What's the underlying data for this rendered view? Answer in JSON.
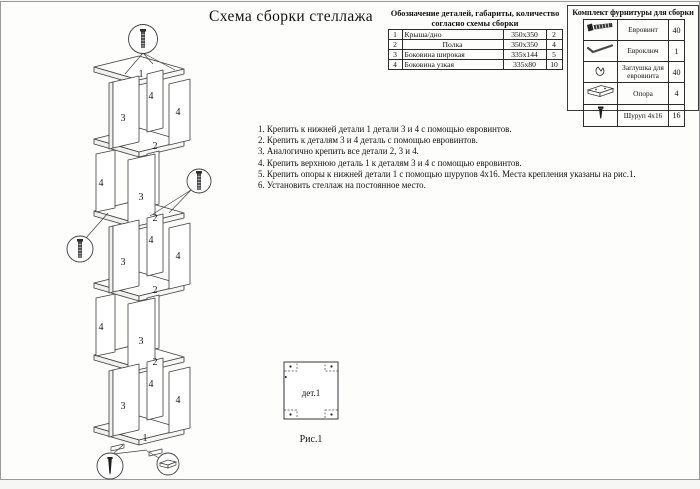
{
  "page": {
    "title": "Схема сборки стеллажа",
    "ink_color": "#2e2e2e",
    "paper_color": "#fdfdfc"
  },
  "parts_table": {
    "header_line1": "Обозначение деталей, габариты, количество",
    "header_line2": "согласно схемы сборки",
    "rows": [
      {
        "num": "1",
        "name": "Крыша/дно",
        "size": "350х350",
        "qty": "2"
      },
      {
        "num": "2",
        "name": "Полка",
        "size": "350х350",
        "qty": "4"
      },
      {
        "num": "3",
        "name": "Боковина широкая",
        "size": "335х144",
        "qty": "5"
      },
      {
        "num": "4",
        "name": "Боковина узкая",
        "size": "335х80",
        "qty": "10"
      }
    ]
  },
  "hardware": {
    "title": "Комплект фурнитуры для сборки",
    "rows": [
      {
        "icon": "eurovint-icon",
        "name": "Евровинт",
        "qty": "40"
      },
      {
        "icon": "hex-key-icon",
        "name": "Евроключ",
        "qty": "1"
      },
      {
        "icon": "cap-icon",
        "name": "Заглушка для евровинта",
        "qty": "40"
      },
      {
        "icon": "support-icon",
        "name": "Опора",
        "qty": "4"
      },
      {
        "icon": "wood-screw-icon",
        "name": "Шуруп 4х16",
        "qty": "16"
      }
    ]
  },
  "instructions": {
    "steps": [
      "1. Крепить к нижней детали 1 детали 3 и 4 с помощью евровинтов.",
      "2. Крепить к деталям 3 и 4 деталь с помощью евровинтов.",
      "3. Аналогично крепить все детали 2, 3 и 4.",
      "4. Крепить верхнюю деталь 1 к деталям 3 и 4 с помощью евровинтов.",
      "5. Крепить опоры к нижней детали 1 с помощью шурупов 4х16. Места крепления указаны на рис.1.",
      "6. Установить стеллаж на постоянное место."
    ]
  },
  "figure": {
    "part_label": "дет.1",
    "caption": "Рис.1"
  },
  "diagram": {
    "labels": {
      "top_bottom_panel": "1",
      "shelf": "2",
      "wide_side": "3",
      "narrow_side": "4"
    }
  }
}
